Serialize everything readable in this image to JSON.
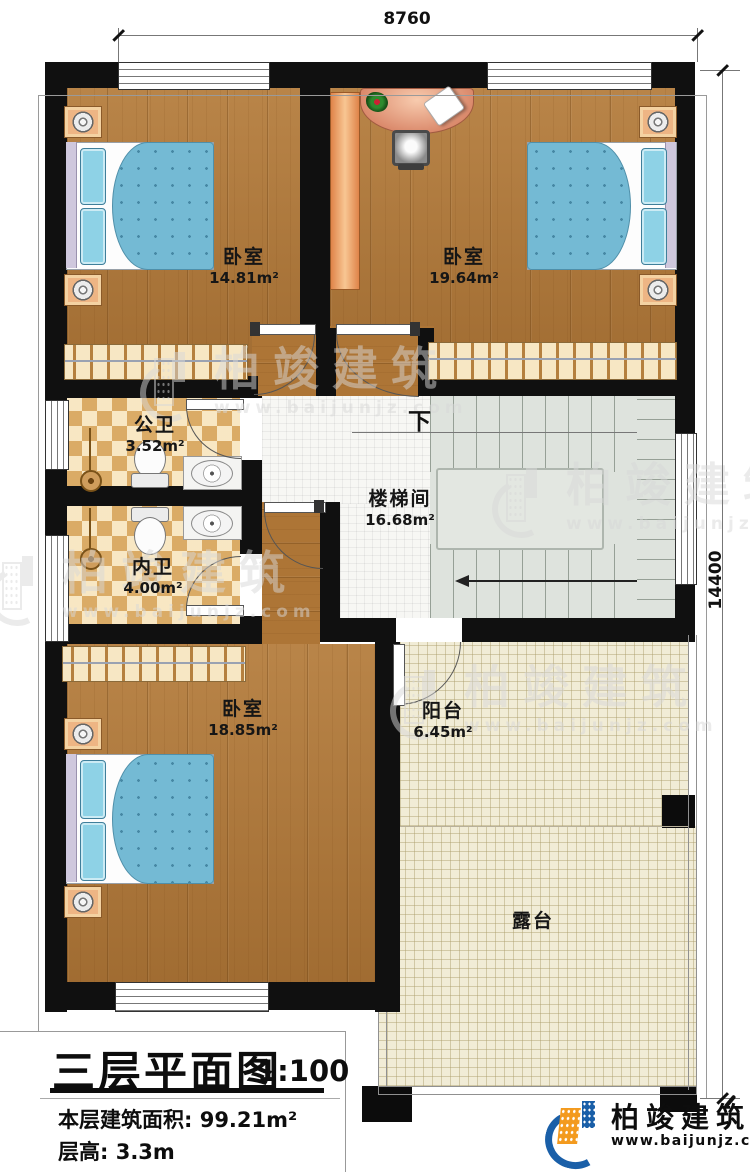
{
  "dimensions": {
    "width_mm": "8760",
    "height_mm": "14400"
  },
  "rooms": {
    "bedroom_tl": {
      "name": "卧室",
      "area": "14.81m²"
    },
    "bedroom_tr": {
      "name": "卧室",
      "area": "19.64m²"
    },
    "public_bath": {
      "name": "公卫",
      "area": "3.52m²"
    },
    "inner_bath": {
      "name": "内卫",
      "area": "4.00m²"
    },
    "stairwell": {
      "name": "楼梯间",
      "area": "16.68m²"
    },
    "bedroom_b": {
      "name": "卧室",
      "area": "18.85m²"
    },
    "balcony": {
      "name": "阳台",
      "area": "6.45m²"
    },
    "terrace": {
      "name": "露台"
    }
  },
  "stairs": {
    "direction_label": "下"
  },
  "title_block": {
    "title": "三层平面图",
    "scale": "1:100",
    "floor_area": "本层建筑面积: 99.21m²",
    "floor_height": "层高: 3.3m"
  },
  "branding": {
    "company": "柏竣建筑",
    "website": "www.baijunjz.com"
  },
  "watermark": {
    "company": "柏竣建筑",
    "website": "www.baijunjz.com"
  },
  "colors": {
    "wall": "#101010",
    "wood": "#b1793a",
    "bath_tile": "#ecd0a0",
    "terrace_tile": "#f1ecd6",
    "stair": "#dee3dd",
    "bed": "#74bad4",
    "brand_blue": "#1a5fa8",
    "brand_orange": "#f39a1e"
  }
}
